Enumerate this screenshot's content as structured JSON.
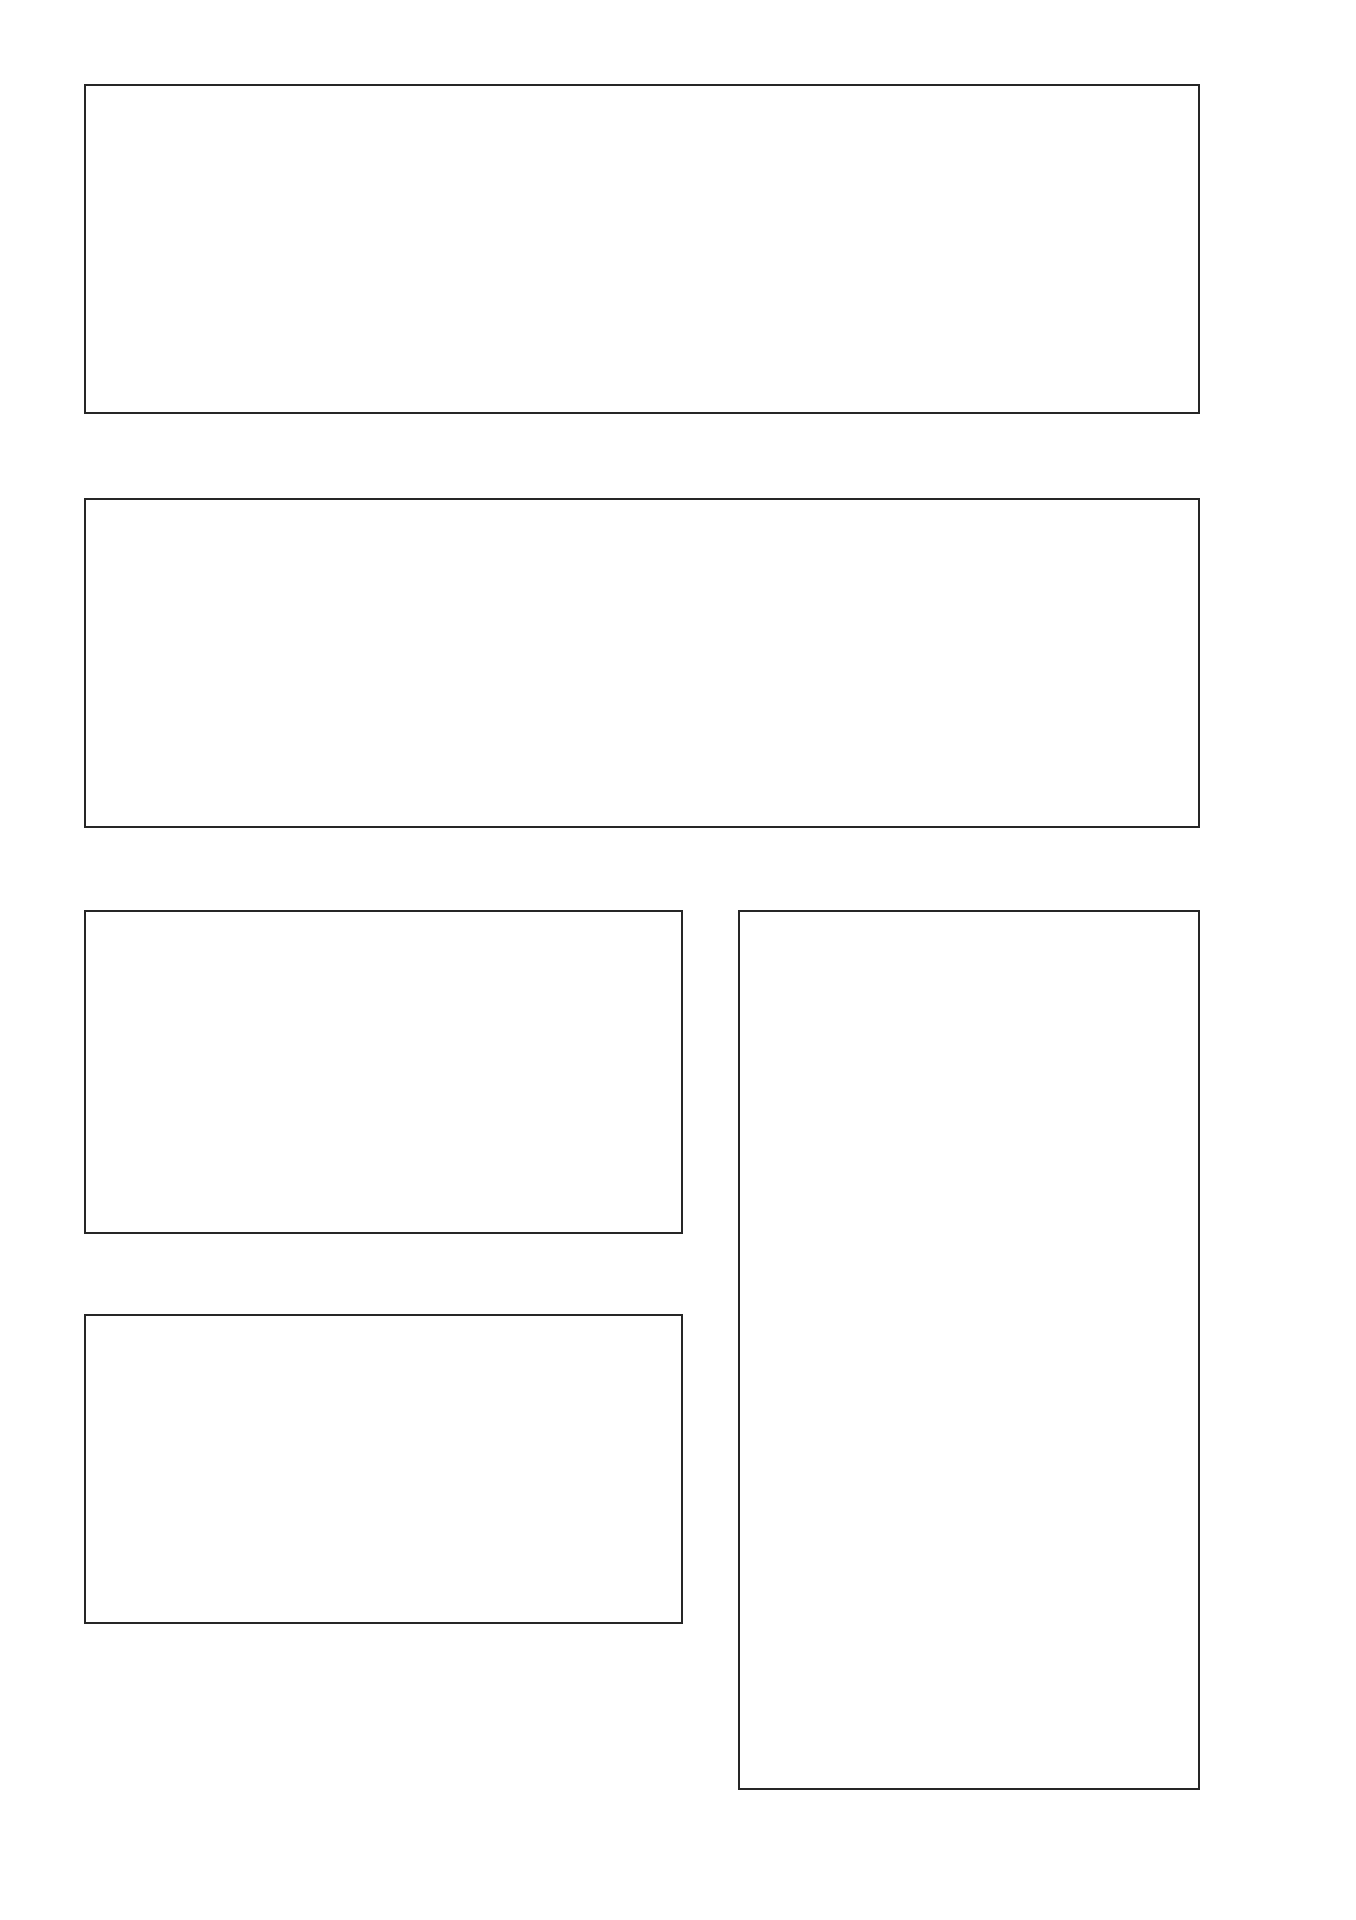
{
  "page": {
    "background": "#ffffff",
    "sidebar_color": "#9c9c9c",
    "accent_teal": "#4faeae",
    "terrain_gray": "#a7a7a7",
    "line_dark": "#1c1c1c",
    "caption_color": "#4a4a4a",
    "north_arrow_color": "#17868b"
  },
  "facade_palette": {
    "pale": "#eef0f8",
    "purple": "#7477c2",
    "purple_light": "#989bd6",
    "teal": "#52bfc1",
    "teal_light": "#a5dee0",
    "white": "#fbfbfd"
  },
  "progress_squares": {
    "filled": 3,
    "total": 10,
    "color": "#221f1d"
  },
  "footer": {
    "background": "#211e1b",
    "line1": "MA1_M-BK | Elementiertes Bauen / Fassaden  |  WS 2013/2014",
    "line2": "PROF. DIPL.-ING. J. LUDWIG  |  DIPL.-ING. (FH) M.A. M.SC. B. GOSSA",
    "credits": "CAROLINE KOCH_516606  |  LEA-MARIE SAUFF_517137  |  KATHRIN SCHMITZ_517177"
  },
  "elevation_sw": {
    "caption": "Ansicht Süd-West | M_1:200",
    "grid_letters": [
      "A",
      "B",
      "C",
      "D",
      "E",
      "F",
      "G",
      "H",
      "I",
      "J",
      "K",
      "L",
      "M"
    ],
    "dims": [
      "4.90",
      "4.59⁵",
      "4.62",
      "5.14⁵",
      "6.41⁵",
      "6.41⁵",
      "6.41⁵",
      "6.41⁵",
      "4.69⁵",
      "5.76",
      "3.79",
      "3.79"
    ],
    "levels_right": [
      "OK ATTIKA 7.79",
      "OK GELÄNDER 7.19",
      "OK GELÄNDE 6.29"
    ],
    "level_ffb_right": "OK FFB 0.00",
    "level_decke": "OK DECKE 4.20",
    "level_ffb_left": "OK FFB 0.00",
    "level_ffb_mid_top": "OK FFB 3.29",
    "level_ffb_mid_bottom": "OK FFB 0.19",
    "road_label": "FEUERWEHRZUFAHRT",
    "panels_top": [
      "pale",
      "purple",
      "teal",
      "teal_light",
      "teal",
      "pale",
      "teal_light",
      "purple",
      "purple_light",
      "pale",
      "pale",
      "purple",
      "teal",
      "teal_light"
    ],
    "panels_bottom": [
      "white",
      "pale",
      "teal_light",
      "white",
      "pale",
      "white",
      "teal_light",
      "pale",
      "white",
      "pale",
      "white",
      "teal_light",
      "pale",
      "white"
    ]
  },
  "section_aa": {
    "caption": "Schnitt A-A | M_1:200",
    "grid_letters": [
      "A",
      "B",
      "C",
      "D",
      "E",
      "F",
      "G",
      "H",
      "I",
      "J",
      "K",
      "L",
      "M"
    ],
    "dims": [
      "4.90",
      "4.59⁵",
      "4.62",
      "5.14⁵",
      "6.41⁵",
      "6.41⁵",
      "6.41⁵",
      "6.41⁵",
      "4.69⁵",
      "5.76",
      "3.79",
      "3.79"
    ],
    "dims_row2": [
      "14.48",
      "35.60",
      "5.00",
      "8.52"
    ],
    "dim_total": "63.59⁵",
    "details": {
      "d": "DETAIL D",
      "h": "DETAIL H",
      "g": "DETAIL G",
      "e": "DETAIL E"
    },
    "levels_right": [
      "OK ATTIKA 7.79",
      "OK GELÄNDER 7.19",
      "OK GELÄNDE 6.29"
    ],
    "level_ffb_right": "OK FFB 0.00",
    "level_decke": "OK DECKE 4.20",
    "level_ffb_left": "OK FFB ±0.00",
    "level_ffb_mid_top": "OK FFB 3.29",
    "level_ffb_mid_bottom": "OK FFB 0.19",
    "road_label": "FEUERWEHRZUFAHRT"
  },
  "elevation_so": {
    "caption": "Ansicht Süd-Ost| M_1:200",
    "grid_numbers": [
      "1",
      "2",
      "3",
      "4",
      "5",
      "6"
    ],
    "dims": [
      "2.67⁵",
      "3.80",
      "6.43⁵",
      "3.81⁵",
      "2.67⁵"
    ],
    "levels_left": [
      "OK ATTIKA 7.79",
      "OK GELÄNDER 7.19",
      "OK GELÄNDE 6.29"
    ],
    "level_ffb": "OK FFB 0.00",
    "road_label": "FEUERWEHRZUFAHRT",
    "panels_top": [
      "pale",
      "purple",
      "purple",
      "purple_light",
      "purple",
      "teal",
      "teal_light"
    ],
    "panels_bottom": [
      "white",
      "pale",
      "teal_light",
      "teal_light",
      "pale",
      "white",
      "pale"
    ]
  },
  "section_bb": {
    "caption": "Schnitt B-B | M_1:200",
    "grid_numbers": [
      "1",
      "2",
      "3",
      "4",
      "5",
      "6"
    ],
    "dims": [
      "2.67⁵",
      "3.80",
      "6.43⁵",
      "3.81⁵",
      "2.67⁵"
    ],
    "dim_total": "19.87",
    "levels_left": [
      "OK ATTIKA 7.79",
      "OK GELÄNDER 7.19",
      "OK GELÄNDE 6.29"
    ],
    "level_decke": "OK DECKE 4.20",
    "level_ffb": "OK FFB 0.00",
    "detail": "DETAIL I",
    "road_label": "FEUERWEHRZUFAHRT"
  },
  "plan": {
    "caption": "Positionsplan (Tragsystem) | M_1:200",
    "grid_numbers": [
      "1",
      "2",
      "3",
      "4",
      "5",
      "6"
    ],
    "grid_letters": [
      "A",
      "B",
      "C",
      "D",
      "E",
      "F",
      "G",
      "H",
      "I",
      "J",
      "K",
      "L",
      "M"
    ],
    "marker_a": "A",
    "marker_b": "B",
    "marker_1": "1",
    "dims_rows": [
      "4.90",
      "4.59⁵",
      "4.62",
      "5.14⁵",
      "6.41⁵",
      "6.41⁵",
      "6.41⁵",
      "6.41⁵",
      "4.69⁵",
      "5.76",
      "3.79",
      "3.79"
    ],
    "dims_rows_sub": [
      "14.48",
      "35.60",
      "5.00",
      "8.52"
    ],
    "dim_rows_total": "63.59⁵",
    "dims_bottom": [
      "2.67⁵",
      "3.80",
      "6.43⁵",
      "3.81⁵",
      "2.67⁵"
    ],
    "dims_bottom_sub": [
      ".50",
      "1.50",
      ".68",
      "14.64",
      ".68",
      "1.50",
      ".50"
    ],
    "dims_bottom_total": "20.11",
    "dims_inner": [
      "2.12⁵",
      "1.51",
      "2.23⁵",
      "3.26",
      "2.23⁵",
      "1.51",
      "2.12⁵"
    ],
    "dim_inner_vertical": "31.51"
  }
}
